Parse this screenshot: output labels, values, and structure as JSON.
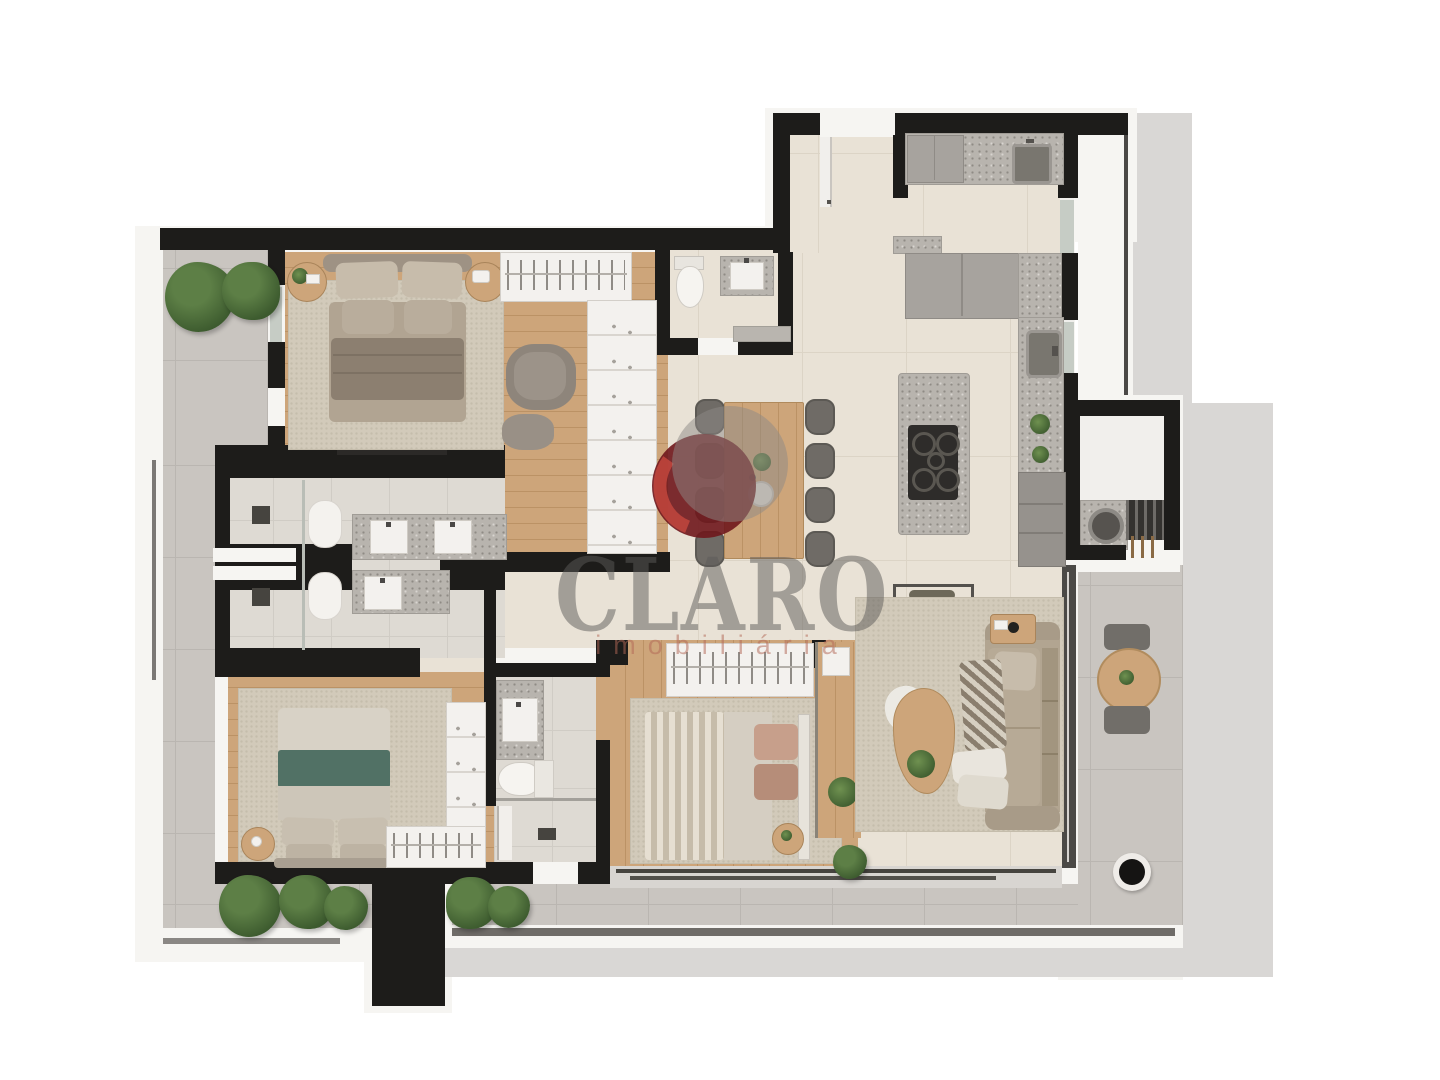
{
  "watermark": {
    "title": "CLARO",
    "subtitle": "imobiliária"
  },
  "palette": {
    "wall": "#1d1c1a",
    "tile": "#e9e2d6",
    "tile_grout": "#dcd4c6",
    "terrace": "#c9c5c0",
    "terrace_grout": "#bab6b1",
    "bath_tile": "#dedad3",
    "bath_grout": "#d0ccc5",
    "wood": "#cda57a",
    "wood_line": "#bb9265",
    "rug": "#d2caba",
    "rug_dot": "#c5bdac",
    "granite": "#b8b4ae",
    "granite_dot": "#8f8b85",
    "cabinet": "#a7a39e",
    "cabinet_edge": "#8f8b86",
    "fixture_white": "#f3f1ee",
    "lining_white": "#f6f5f2",
    "flat_gray": "#d9d7d5",
    "glass": "#c6ccc5",
    "frame_dark": "#4b4946",
    "sofa": "#b2a591",
    "sofa_dark": "#a89b88",
    "cushion": "#c7bcab",
    "plant": "#5d7f46",
    "plant_dark": "#3c5a2e",
    "bed_green": "#517165",
    "headboard": "#9e9284",
    "logo_red": "#6f171c",
    "logo_red_bright": "#c2463d",
    "logo_gray": "#8d8a85",
    "wm_text": "rgba(92,90,87,0.50)",
    "wm_sub": "rgba(178,104,86,0.52)"
  }
}
